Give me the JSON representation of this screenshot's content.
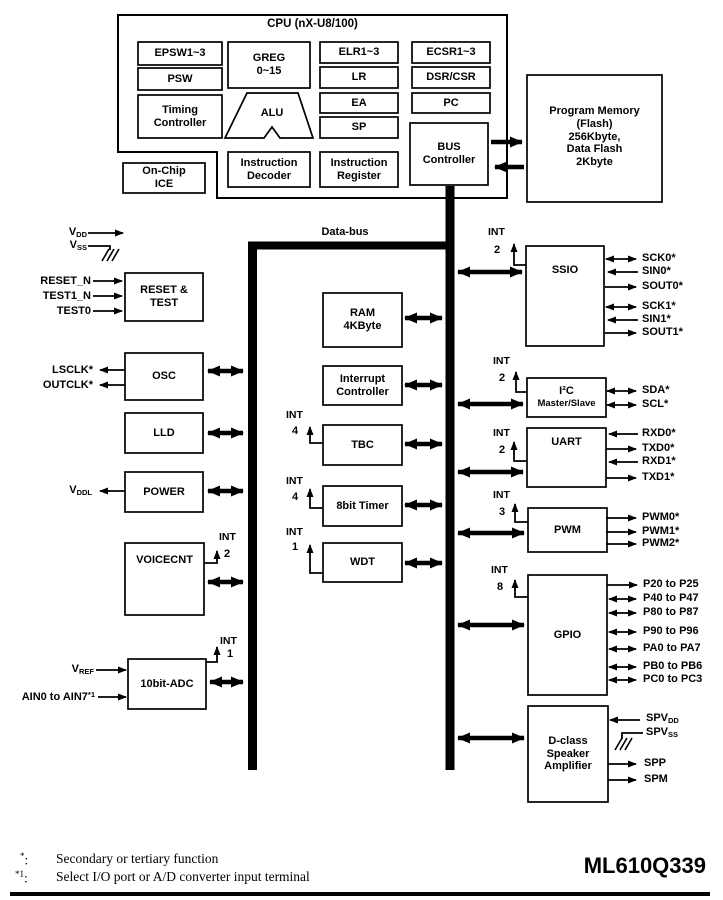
{
  "data_bus": "Data-bus",
  "int_text": "INT",
  "cpu": {
    "title": "CPU (nX-U8/100)",
    "epsw": "EPSW1~3",
    "psw": "PSW",
    "timing_controller": "Timing Controller",
    "greg": [
      "GREG",
      "0~15"
    ],
    "alu": "ALU",
    "elr": "ELR1~3",
    "lr": "LR",
    "ea": "EA",
    "sp": "SP",
    "ecsr": "ECSR1~3",
    "dsr_csr": "DSR/CSR",
    "pc": "PC",
    "bus_controller": "BUS Controller",
    "instruction_decoder": "Instruction Decoder",
    "instruction_register": "Instruction Register"
  },
  "on_chip_ice": [
    "On-Chip",
    "ICE"
  ],
  "program_memory": [
    "Program Memory",
    "(Flash)",
    "256Kbyte,",
    "Data Flash",
    "2Kbyte"
  ],
  "left": {
    "vdd": {
      "base": "V",
      "sub": "DD"
    },
    "vss": {
      "base": "V",
      "sub": "SS"
    },
    "reset_n": "RESET_N",
    "test1_n": "TEST1_N",
    "test0": "TEST0",
    "reset_test": "RESET & TEST",
    "lsclk": "LSCLK*",
    "outclk": "OUTCLK*",
    "osc": "OSC",
    "lld": "LLD",
    "vddl": {
      "base": "V",
      "sub": "DDL"
    },
    "power": "POWER",
    "voicecnt": "VOICECNT",
    "voicecnt_int": "2",
    "vref": {
      "base": "V",
      "sub": "REF"
    },
    "ain": {
      "base": "AIN0 to AIN7",
      "sup": "*1"
    },
    "adc": "10bit-ADC",
    "adc_int": "1"
  },
  "middle": {
    "ram": [
      "RAM",
      "4KByte"
    ],
    "interrupt_controller": "Interrupt Controller",
    "tbc": "TBC",
    "tbc_int": "4",
    "timer8": "8bit Timer",
    "timer8_int": "4",
    "wdt": "WDT",
    "wdt_int": "1"
  },
  "right": {
    "ssio": {
      "label": "SSIO",
      "int": "2",
      "signals": [
        "SCK0*",
        "SIN0*",
        "SOUT0*",
        "SCK1*",
        "SIN1*",
        "SOUT1*"
      ]
    },
    "i2c": {
      "line1": "I²C",
      "line2": "Master/Slave",
      "int": "2",
      "signals": [
        "SDA*",
        "SCL*"
      ]
    },
    "uart": {
      "label": "UART",
      "int": "2",
      "signals": [
        "RXD0*",
        "TXD0*",
        "RXD1*",
        "TXD1*"
      ]
    },
    "pwm": {
      "label": "PWM",
      "int": "3",
      "signals": [
        "PWM0*",
        "PWM1*",
        "PWM2*"
      ]
    },
    "gpio": {
      "label": "GPIO",
      "int": "8",
      "signals": [
        "P20 to P25",
        "P40 to P47",
        "P80 to P87",
        "P90 to P96",
        "PA0 to PA7",
        "PB0 to PB6",
        "PC0 to PC3"
      ]
    },
    "dclass": {
      "lines": [
        "D-class",
        "Speaker",
        "Amplifier"
      ],
      "spvdd": {
        "base": "SPV",
        "sub": "DD"
      },
      "spvss": {
        "base": "SPV",
        "sub": "SS"
      },
      "spp": "SPP",
      "spm": "SPM"
    }
  },
  "footer": {
    "fn1_marker": "*",
    "fn1_sep": ":",
    "fn1_text": "Secondary or tertiary function",
    "fn2_marker": "*1",
    "fn2_sep": ":",
    "fn2_text": "Select I/O port or A/D converter input terminal",
    "part_number": "ML610Q339"
  },
  "colors": {
    "ink": "#000000",
    "background": "#ffffff"
  }
}
